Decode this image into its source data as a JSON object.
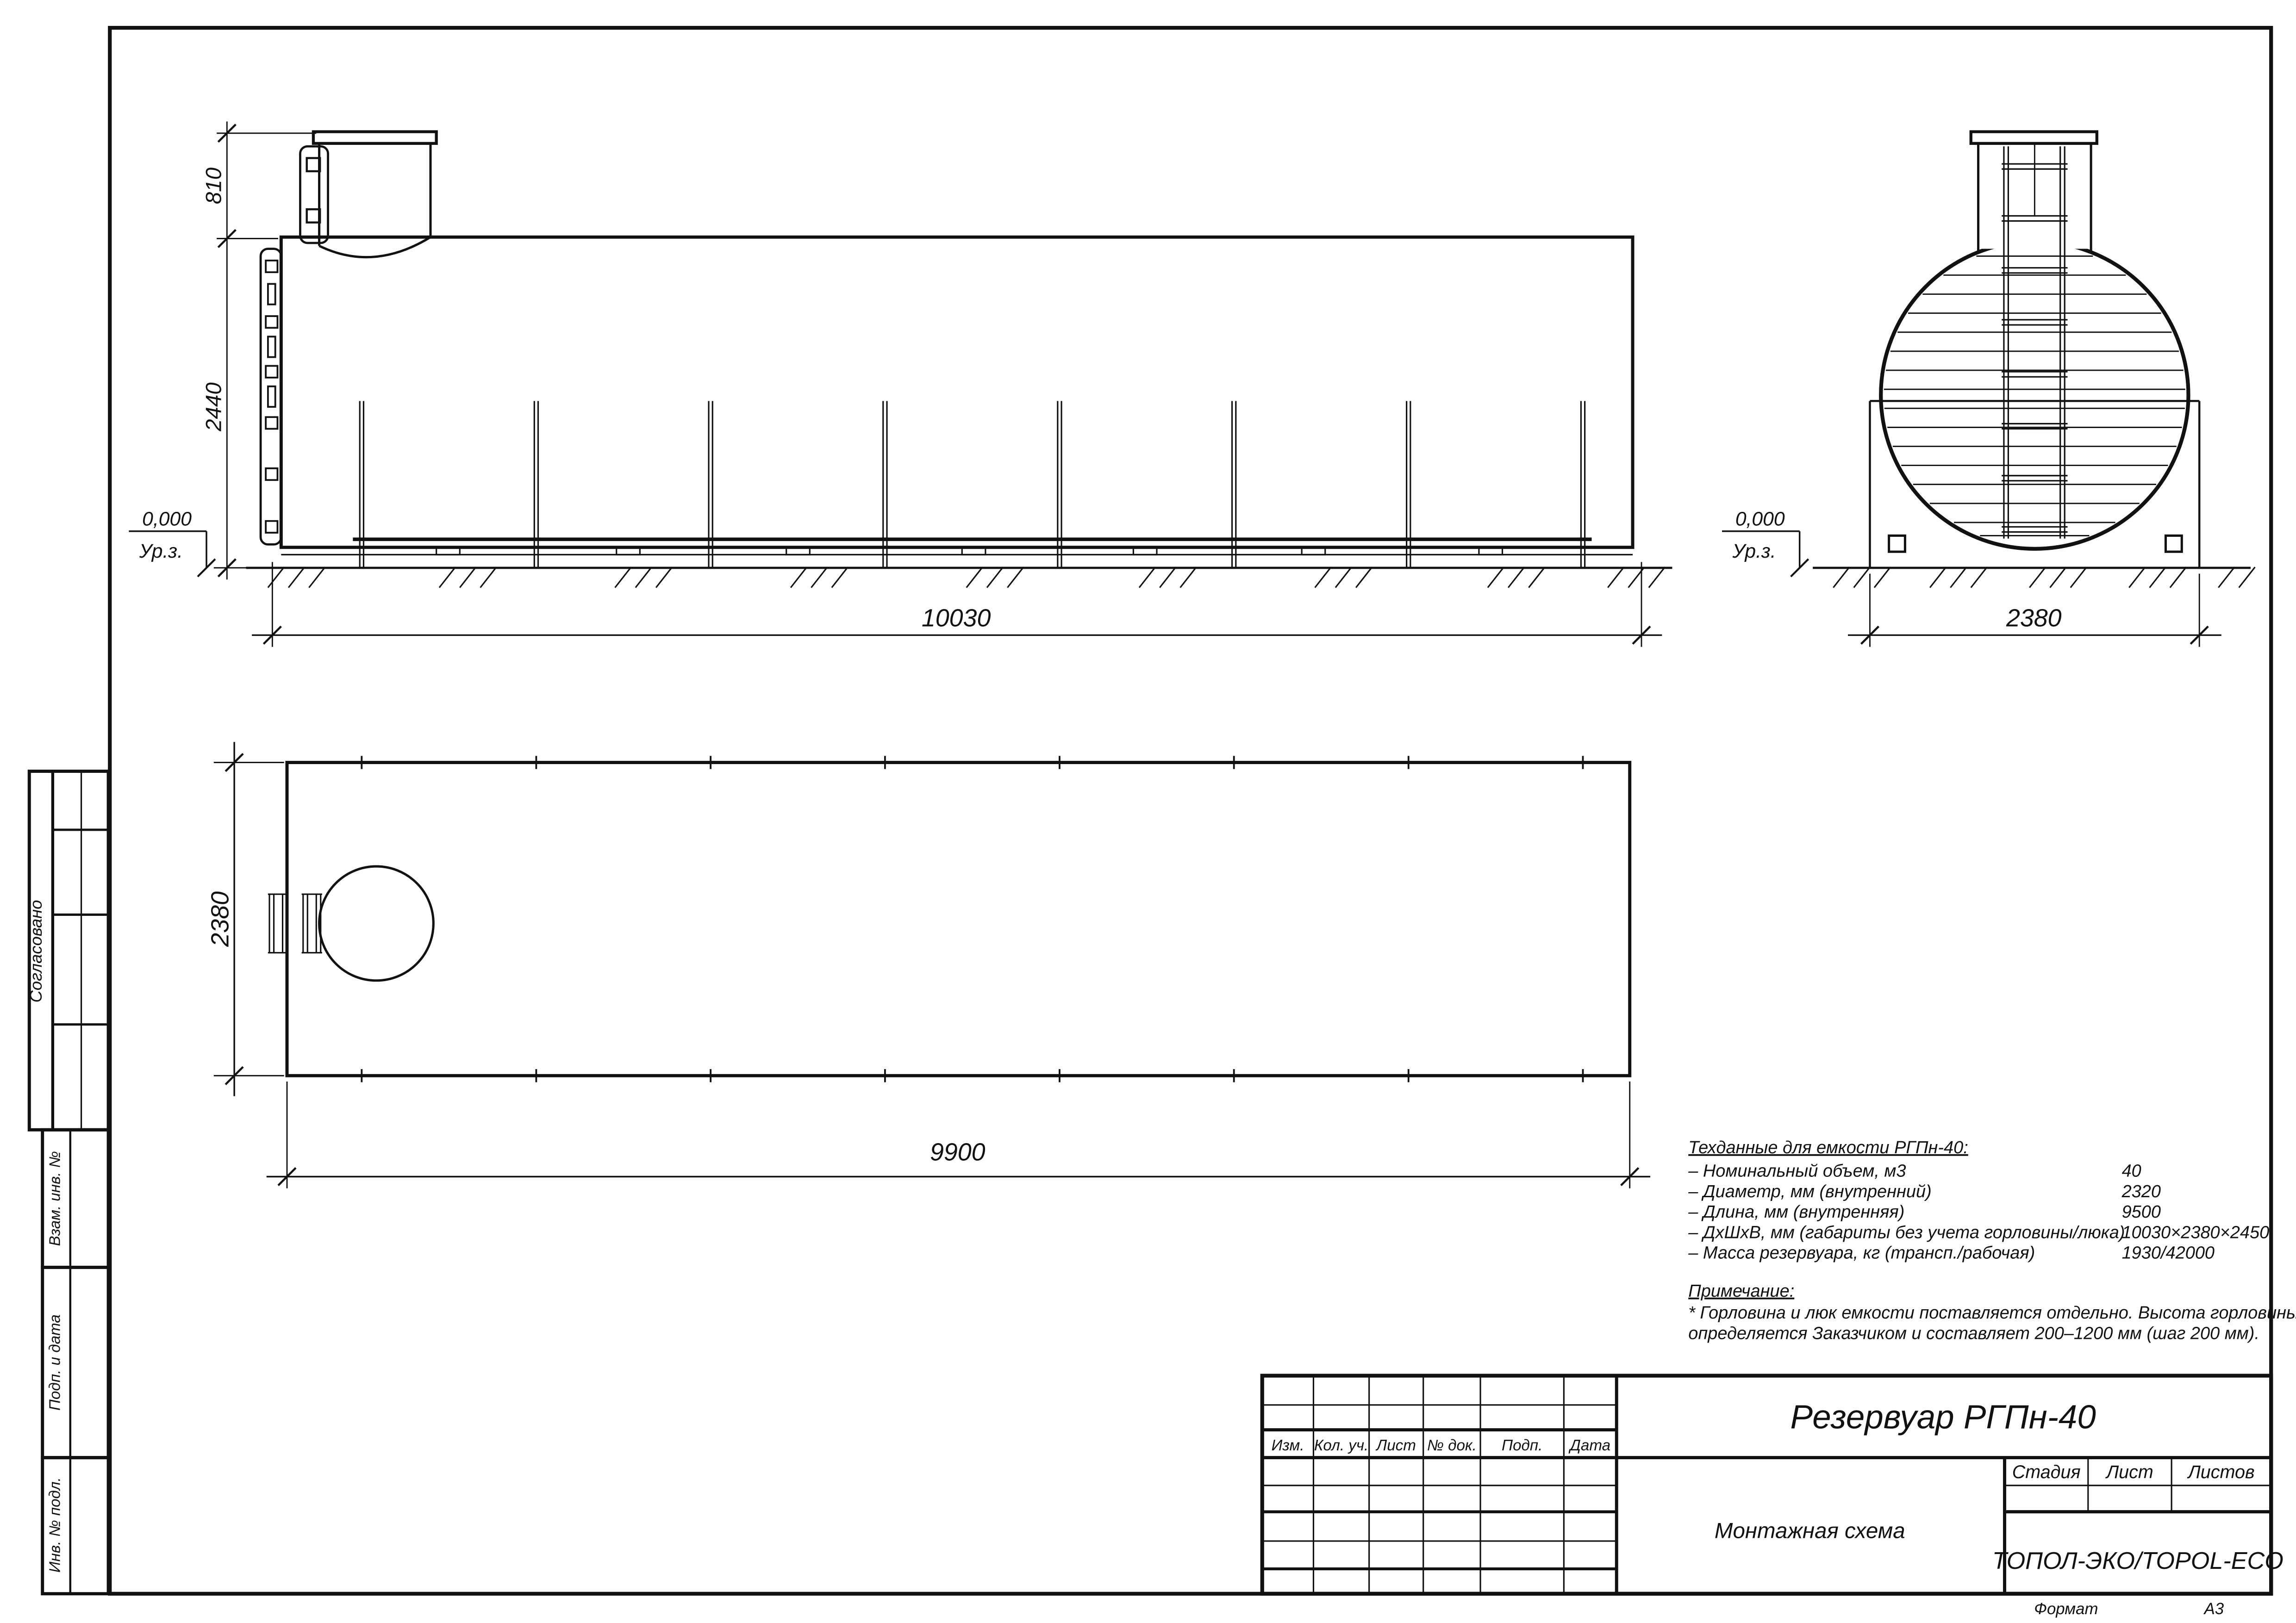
{
  "drawing": {
    "side_view": {
      "dim_neck_height": "810",
      "dim_tank_height": "2440",
      "dim_length": "10030",
      "level_value": "0,000",
      "level_label": "Ур.з."
    },
    "end_view": {
      "dim_width": "2380",
      "level_value": "0,000",
      "level_label": "Ур.з."
    },
    "plan_view": {
      "dim_width": "2380",
      "dim_length": "9900"
    },
    "tech_data": {
      "heading": "Техданные для емкости РГПн-40:",
      "items": [
        {
          "label": "– Номинальный объем, м3",
          "value": "40"
        },
        {
          "label": "– Диаметр, мм (внутренний)",
          "value": "2320"
        },
        {
          "label": "– Длина, мм (внутренняя)",
          "value": "9500"
        },
        {
          "label": "– ДхШхВ, мм (габариты без учета горловины/люка)",
          "value": "10030×2380×2450"
        },
        {
          "label": "– Масса резервуара, кг (трансп./рабочая)",
          "value": "1930/42000"
        }
      ],
      "note_heading": "Примечание:",
      "note_line1": "* Горловина и люк емкости поставляется отдельно. Высота горловины",
      "note_line2": "определяется Заказчиком и составляет 200–1200 мм (шаг 200 мм)."
    },
    "title_block": {
      "title": "Резервуар РГПн-40",
      "doc_type": "Монтажная схема",
      "company": "ТОПОЛ-ЭКО/TOPOL-ECO",
      "columns": [
        "Изм.",
        "Кол. уч.",
        "Лист",
        "№ док.",
        "Подп.",
        "Дата"
      ],
      "stage_label": "Стадия",
      "sheet_label": "Лист",
      "sheets_label": "Листов",
      "format_label": "Формат",
      "format_value": "А3"
    },
    "side_stamps": {
      "approved": "Согласовано",
      "replace_inv": "Взам. инв. №",
      "sign_date": "Подп. и дата",
      "inv_orig": "Инв. № подл."
    }
  }
}
